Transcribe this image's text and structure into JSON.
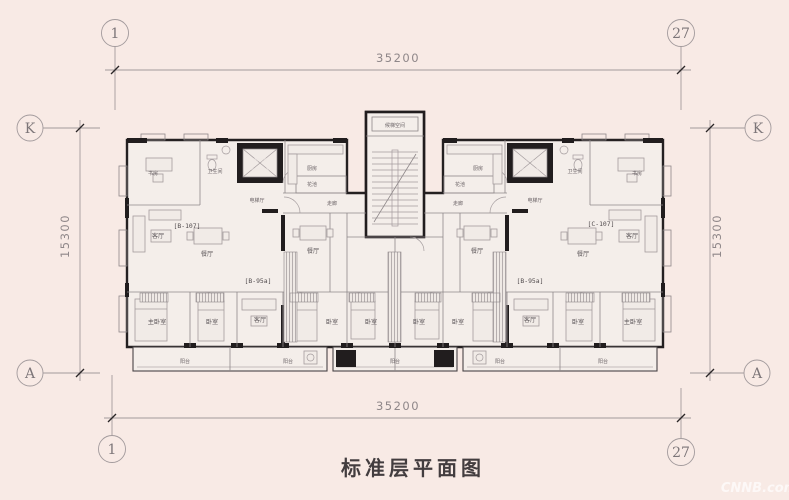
{
  "title": "标准层平面图",
  "watermark": "CNNB.com.cn",
  "axes": {
    "col_start": "1",
    "col_end": "27",
    "row_k": "K",
    "row_a": "A"
  },
  "dimensions": {
    "width": "35200",
    "height": "15300"
  },
  "units": {
    "left_end": "[B-107]",
    "mid": "[B-95a]",
    "right_end": "[C-107]"
  },
  "rooms": {
    "study": "书房",
    "kitchen": "厨房",
    "bath": "卫生间",
    "living": "客厅",
    "dining": "餐厅",
    "master_bedroom": "主卧室",
    "bedroom": "卧室",
    "balcony": "阳台",
    "corridor": "走廊",
    "flower_bed": "花池",
    "elevator_hall": "电梯厅",
    "stair_space": "候梯空间",
    "fire_elevator": "消防电梯",
    "accessible_elevator": "无障碍电梯",
    "elevator": "电梯",
    "elevator_note": "(无障碍电梯)"
  }
}
